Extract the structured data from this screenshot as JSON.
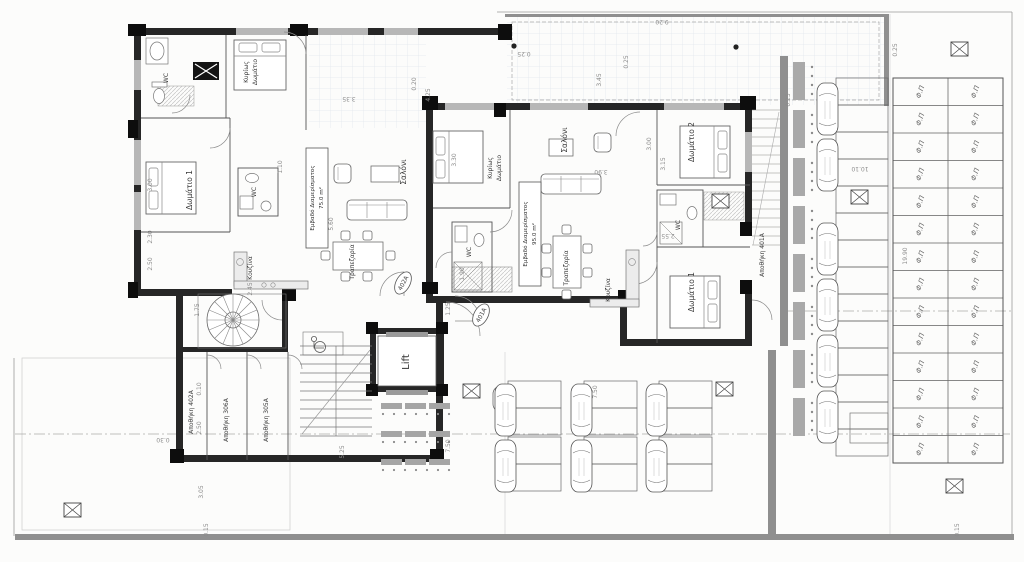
{
  "plan": {
    "rooms": {
      "wc": "WC",
      "master_l1": "Κυρίως",
      "master_l2": "Δωμάτιο",
      "room1": "Δωμάτιο 1",
      "room2": "Δωμάτιο 2",
      "living": "Σαλόνι",
      "dining": "Τραπεζαρία",
      "kitchen": "Κουζίνα",
      "area_l1": "Εμβαδό Διαμερίσματος",
      "area_a_l2": "75.0 m²",
      "area_b_l2": "95.0 m²",
      "lift": "Lift",
      "storage_401": "Αποθήκη 401Α",
      "storage_402": "Αποθήκη 402Α",
      "storage_306": "Αποθήκη 306Α",
      "storage_305": "Αποθήκη 305Α"
    },
    "unit_tags": {
      "a": "402A",
      "b": "401A"
    },
    "pv_label": "Φ.Π",
    "pv_grid": {
      "cols": 2,
      "rows": 14
    },
    "dims": [
      {
        "t": "9.20",
        "x": 662,
        "y": 20,
        "r": 180
      },
      {
        "t": "0.25",
        "x": 524,
        "y": 52,
        "r": 180
      },
      {
        "t": "0.25",
        "x": 628,
        "y": 62,
        "r": -90
      },
      {
        "t": "3.45",
        "x": 601,
        "y": 80,
        "r": -90
      },
      {
        "t": "0.25",
        "x": 897,
        "y": 50,
        "r": -90
      },
      {
        "t": "4.25",
        "x": 430,
        "y": 95,
        "r": -90
      },
      {
        "t": "3.35",
        "x": 349,
        "y": 97,
        "r": 180
      },
      {
        "t": "0.20",
        "x": 416,
        "y": 84,
        "r": -90
      },
      {
        "t": "3.00",
        "x": 152,
        "y": 185,
        "r": -90
      },
      {
        "t": "2.30",
        "x": 152,
        "y": 237,
        "r": -90
      },
      {
        "t": "2.50",
        "x": 152,
        "y": 264,
        "r": -90
      },
      {
        "t": "3.30",
        "x": 456,
        "y": 160,
        "r": -90
      },
      {
        "t": "3.00",
        "x": 651,
        "y": 144,
        "r": -90
      },
      {
        "t": "3.15",
        "x": 665,
        "y": 164,
        "r": -90
      },
      {
        "t": "5.60",
        "x": 333,
        "y": 224,
        "r": -90
      },
      {
        "t": "1.10",
        "x": 282,
        "y": 167,
        "r": -90
      },
      {
        "t": "3.90",
        "x": 601,
        "y": 170,
        "r": 180
      },
      {
        "t": "1.90",
        "x": 464,
        "y": 274,
        "r": -90
      },
      {
        "t": "2.55",
        "x": 668,
        "y": 234,
        "r": 180
      },
      {
        "t": "1.75",
        "x": 199,
        "y": 310,
        "r": -90
      },
      {
        "t": "2.45",
        "x": 252,
        "y": 289,
        "r": -90
      },
      {
        "t": "1.25",
        "x": 450,
        "y": 309,
        "r": -90
      },
      {
        "t": "0.10",
        "x": 201,
        "y": 389,
        "r": -90
      },
      {
        "t": "2.50",
        "x": 201,
        "y": 428,
        "r": -90
      },
      {
        "t": "3.05",
        "x": 203,
        "y": 492,
        "r": -90
      },
      {
        "t": "5.25",
        "x": 344,
        "y": 452,
        "r": -90
      },
      {
        "t": "7.50",
        "x": 597,
        "y": 392,
        "r": -90
      },
      {
        "t": "7.50",
        "x": 450,
        "y": 446,
        "r": -90
      },
      {
        "t": "10.10",
        "x": 860,
        "y": 167,
        "r": 180
      },
      {
        "t": "19.90",
        "x": 907,
        "y": 256,
        "r": -90
      },
      {
        "t": "0.15",
        "x": 208,
        "y": 530,
        "r": -90
      },
      {
        "t": "0.15",
        "x": 959,
        "y": 530,
        "r": -90
      },
      {
        "t": "0.25",
        "x": 790,
        "y": 100,
        "r": -90
      },
      {
        "t": "0.30",
        "x": 163,
        "y": 438,
        "r": 180
      }
    ],
    "cars": [
      {
        "x": 495,
        "y": 384
      },
      {
        "x": 495,
        "y": 440
      },
      {
        "x": 571,
        "y": 384
      },
      {
        "x": 571,
        "y": 440
      },
      {
        "x": 646,
        "y": 384
      },
      {
        "x": 646,
        "y": 440
      },
      {
        "x": 817,
        "y": 83
      },
      {
        "x": 817,
        "y": 139
      },
      {
        "x": 817,
        "y": 223
      },
      {
        "x": 817,
        "y": 279
      },
      {
        "x": 817,
        "y": 335
      },
      {
        "x": 817,
        "y": 391
      }
    ]
  }
}
